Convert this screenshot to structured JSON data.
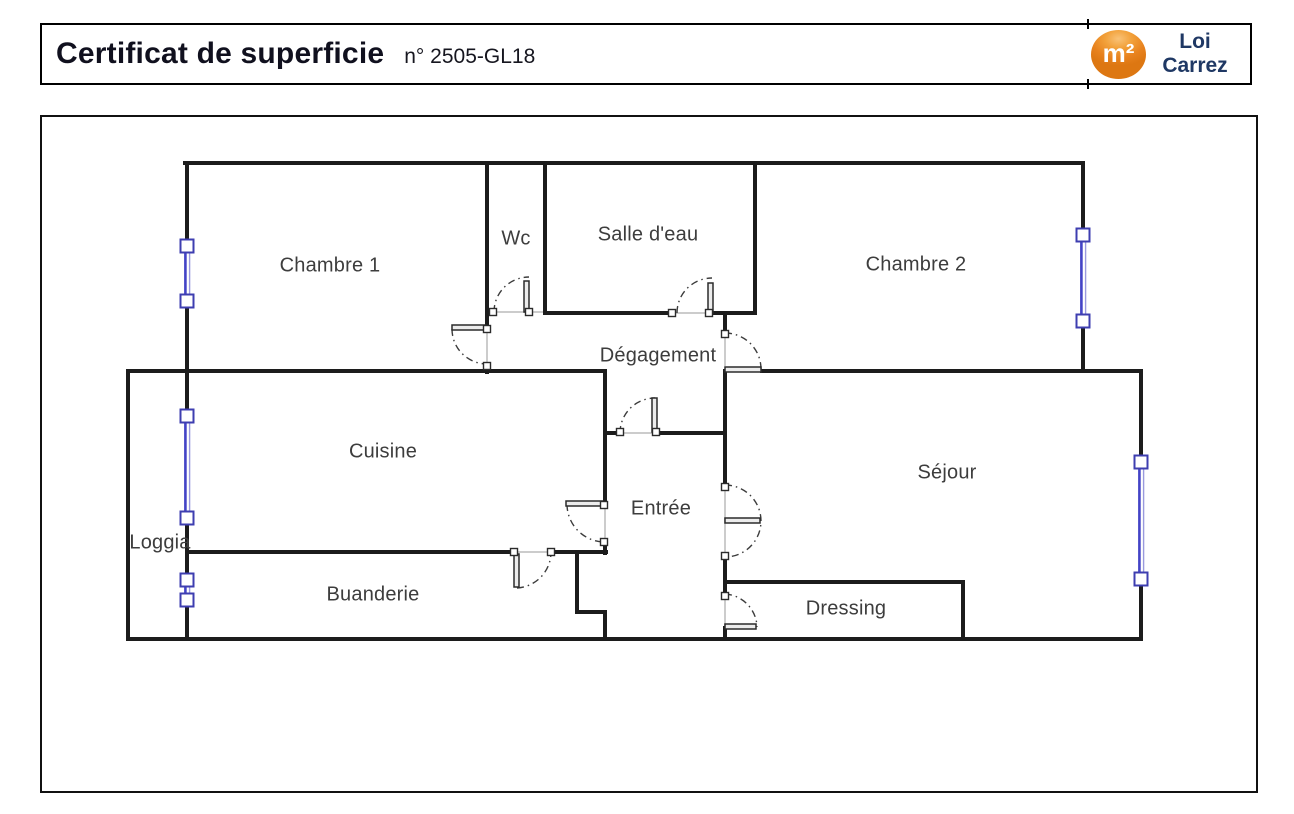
{
  "header": {
    "title": "Certificat de superficie",
    "doc_number": "n° 2505-GL18",
    "logo": {
      "symbol": "m²",
      "line1": "Loi",
      "line2": "Carrez",
      "circle_color": "#e8821e",
      "text_color": "#1f3864"
    }
  },
  "plan": {
    "rooms": [
      {
        "id": "chambre-1",
        "label": "Chambre 1"
      },
      {
        "id": "wc",
        "label": "Wc"
      },
      {
        "id": "salle-deau",
        "label": "Salle d'eau"
      },
      {
        "id": "chambre-2",
        "label": "Chambre 2"
      },
      {
        "id": "degagement",
        "label": "Dégagement"
      },
      {
        "id": "cuisine",
        "label": "Cuisine"
      },
      {
        "id": "entree",
        "label": "Entrée"
      },
      {
        "id": "sejour",
        "label": "Séjour"
      },
      {
        "id": "loggia",
        "label": "Loggia"
      },
      {
        "id": "buanderie",
        "label": "Buanderie"
      },
      {
        "id": "dressing",
        "label": "Dressing"
      }
    ],
    "colors": {
      "wall": "#1c1c1c",
      "window": "#4343c6",
      "label": "#3d3d3d",
      "door_arc": "#3c3c3c"
    }
  }
}
